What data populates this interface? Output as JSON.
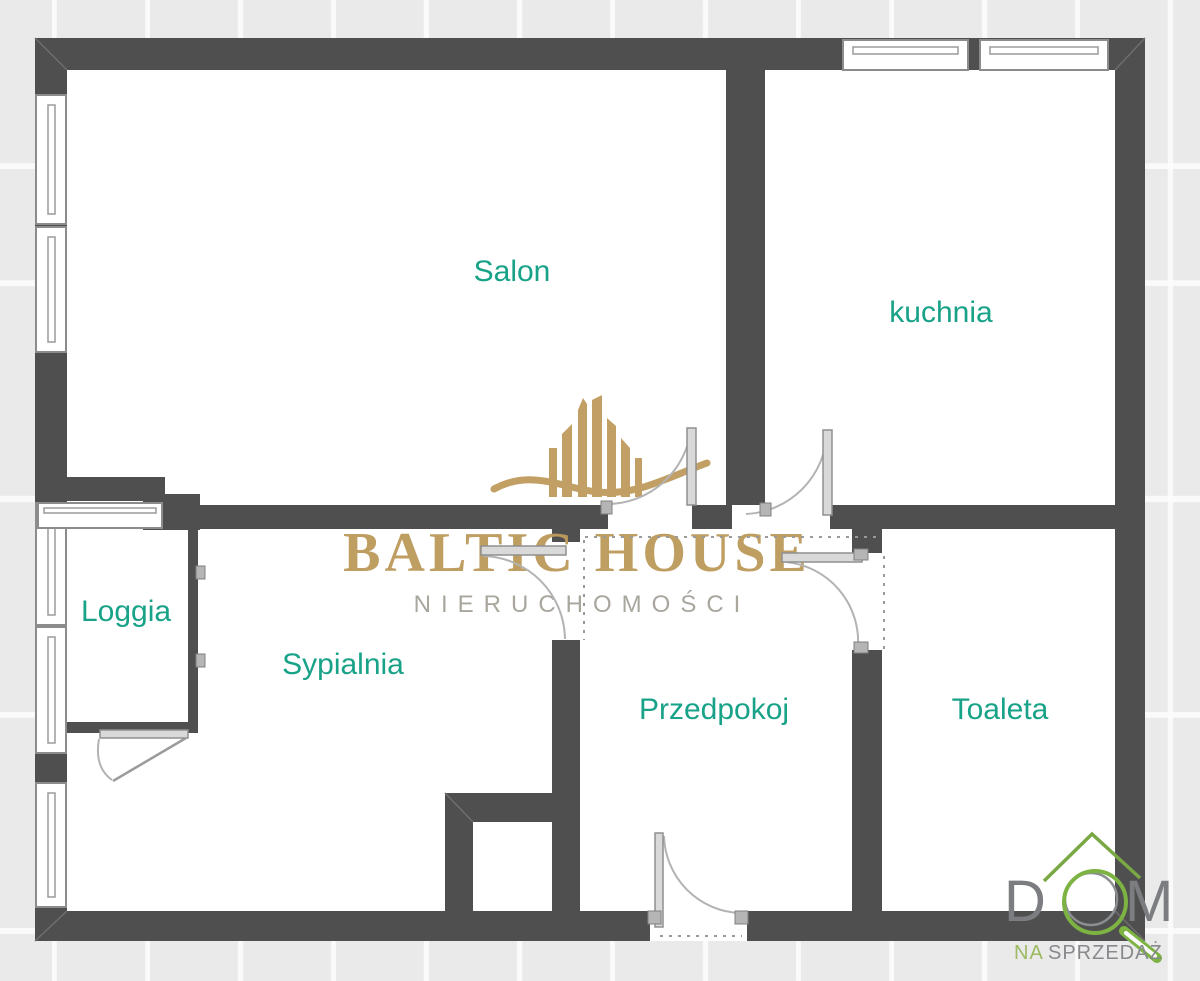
{
  "plan": {
    "type": "apartment-floor-plan",
    "rooms": {
      "salon": "Salon",
      "kitchen": "kuchnia",
      "loggia": "Loggia",
      "bedroom": "Sypialnia",
      "hallway": "Przedpokoj",
      "toilet": "Toaleta"
    }
  },
  "watermark": {
    "title": "BALTIC HOUSE",
    "subtitle": "NIERUCHOMOŚCI"
  },
  "corner_logo": {
    "letter_d": "D",
    "letter_m": "M",
    "tagline_accent": "NA",
    "tagline_rest": "SPRZEDAŻ"
  },
  "colors": {
    "wall": "#4f4f4f",
    "room_label": "#18a288",
    "watermark_gold": "#c09c5e",
    "logo_green": "#7cb342",
    "logo_gray": "#7b7d80",
    "background_tile": "#eaeaea"
  }
}
